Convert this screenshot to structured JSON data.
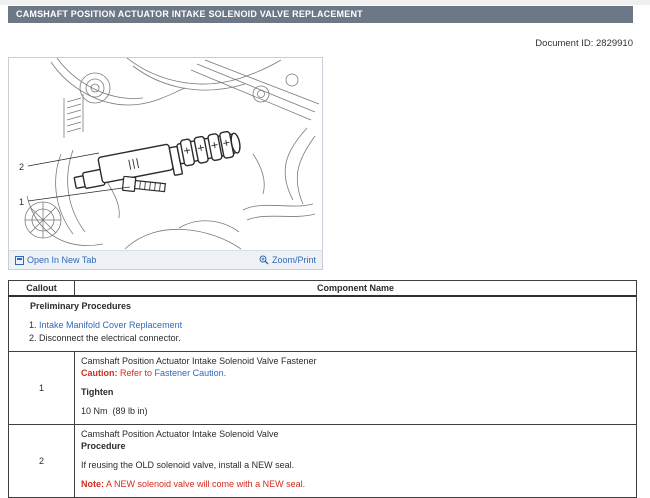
{
  "page": {
    "title": "CAMSHAFT POSITION ACTUATOR INTAKE SOLENOID VALVE REPLACEMENT",
    "document_id": "Document ID: 2829910"
  },
  "figure": {
    "open_in_new_tab_label": "Open In New Tab",
    "zoom_print_label": "Zoom/Print",
    "callout_1": "1",
    "callout_2": "2"
  },
  "table": {
    "headers": {
      "callout": "Callout",
      "component": "Component Name"
    },
    "preliminary": {
      "title": "Preliminary Procedures",
      "item_1": "Intake Manifold Cover Replacement",
      "item_2": "Disconnect the electrical connector."
    },
    "rows": [
      {
        "callout": "1",
        "component": "Camshaft Position Actuator Intake Solenoid Valve Fastener",
        "caution_label": "Caution:",
        "caution_pre": "Refer to",
        "caution_link": "Fastener Caution",
        "caution_post": ".",
        "subhead": "Tighten",
        "spec": "10 Nm  (89 lb in)"
      },
      {
        "callout": "2",
        "component": "Camshaft Position Actuator Intake Solenoid Valve",
        "subhead": "Procedure",
        "body": "If reusing the OLD solenoid valve, install a NEW seal.",
        "note_label": "Note:",
        "note_text": "A NEW solenoid valve will come with a NEW seal."
      }
    ]
  },
  "colors": {
    "title_bar_bg": "#6d7887",
    "link_blue": "#3069b9",
    "alert_red": "#d32b1e"
  }
}
